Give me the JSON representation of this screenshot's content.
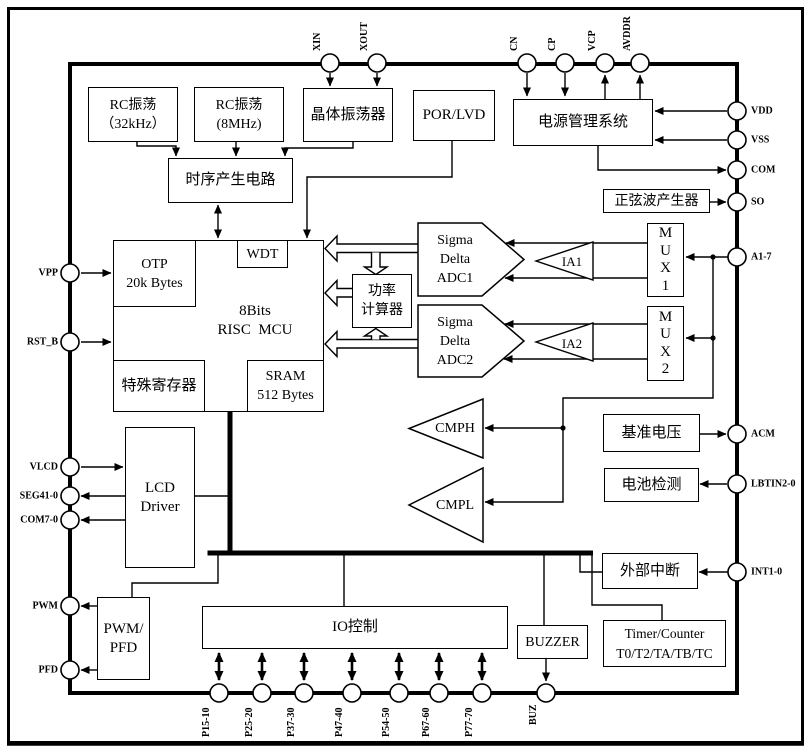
{
  "figure": {
    "kind": "soc-block-diagram",
    "colors": {
      "line": "#000000",
      "background": "#ffffff"
    }
  },
  "blocks": {
    "rc32k": "RC振荡\n（32kHz）",
    "rc8m": "RC振荡\n(8MHz)",
    "crystal_osc": "晶体振荡器",
    "por_lvd": "POR/LVD",
    "power_mgmt": "电源管理系统",
    "timing_gen": "时序产生电路",
    "sine_gen": "正弦波产生器",
    "otp": "OTP\n20k Bytes",
    "wdt": "WDT",
    "mcu": "8Bits\nRISC  MCU",
    "special_regs": "特殊寄存器",
    "sram": "SRAM\n512 Bytes",
    "power_calc": "功率\n计算器",
    "adc1": "Sigma\nDelta\nADC1",
    "adc2": "Sigma\nDelta\nADC2",
    "ia1": "IA1",
    "ia2": "IA2",
    "mux1": "M\nU\nX\n1",
    "mux2": "M\nU\nX\n2",
    "cmph": "CMPH",
    "cmpl": "CMPL",
    "vref": "基准电压",
    "battery_detect": "电池检测",
    "ext_interrupt": "外部中断",
    "timer": "Timer/Counter\nT0/T2/TA/TB/TC",
    "lcd_driver": "LCD\nDriver",
    "pwm_pfd": "PWM/\nPFD",
    "io_ctrl": "IO控制",
    "buzzer": "BUZZER"
  },
  "pins": {
    "top": [
      "XIN",
      "XOUT",
      "CN",
      "CP",
      "VCP",
      "AVDDR"
    ],
    "right": [
      "VDD",
      "VSS",
      "COM",
      "SO",
      "A1-7",
      "ACM",
      "LBTIN2-0",
      "INT1-0"
    ],
    "left": [
      "VPP",
      "RST_B",
      "VLCD",
      "SEG41-0",
      "COM7-0",
      "PWM",
      "PFD"
    ],
    "bottom": [
      "P15-10",
      "P25-20",
      "P37-30",
      "P47-40",
      "P54-50",
      "P67-60",
      "P77-70",
      "BUZ"
    ]
  }
}
